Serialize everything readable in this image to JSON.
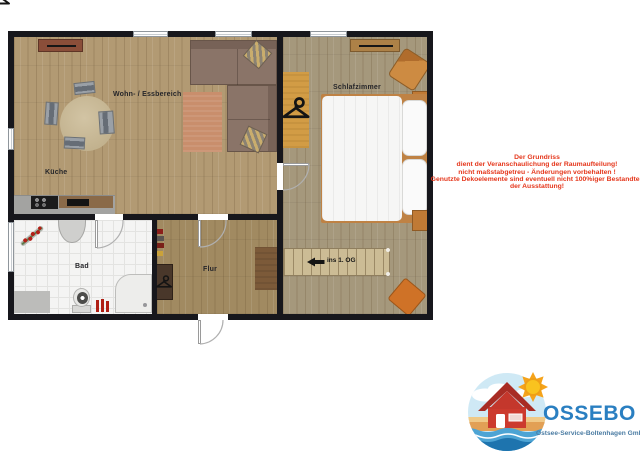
{
  "plan": {
    "rooms": [
      {
        "id": "living-dining",
        "label": "Wohn- / Essbereich"
      },
      {
        "id": "kitchen",
        "label": "Küche"
      },
      {
        "id": "bedroom",
        "label": "Schlafzimmer"
      },
      {
        "id": "bathroom",
        "label": "Bad"
      },
      {
        "id": "hallway",
        "label": "Flur"
      }
    ],
    "stairs_label": "ins 1. OG"
  },
  "disclaimer": {
    "lines": [
      "Der Grundriss",
      "dient der Veranschaulichung der Raumaufteilung!",
      "nicht maßstabgetreu - Änderungen vorbehalten !",
      "Genutzte Dekoelemente sind eventuell nicht 100%iger Bestandteil",
      "der Ausstattung!"
    ],
    "color": "#e5371c"
  },
  "logo": {
    "name": "OSSEBO",
    "tagline": "Ostsee-Service-Boltenhagen GmbH",
    "name_color": "#2a7fc1",
    "icons": [
      "house-icon",
      "sun-icon",
      "wave-icon",
      "cloud-icon"
    ]
  },
  "colors": {
    "wall": "#17171c",
    "floor_wood": "#b29a73",
    "floor_tile": "#f4f4f3",
    "accent_orange": "#cf7227",
    "sofa": "#8a7468"
  }
}
